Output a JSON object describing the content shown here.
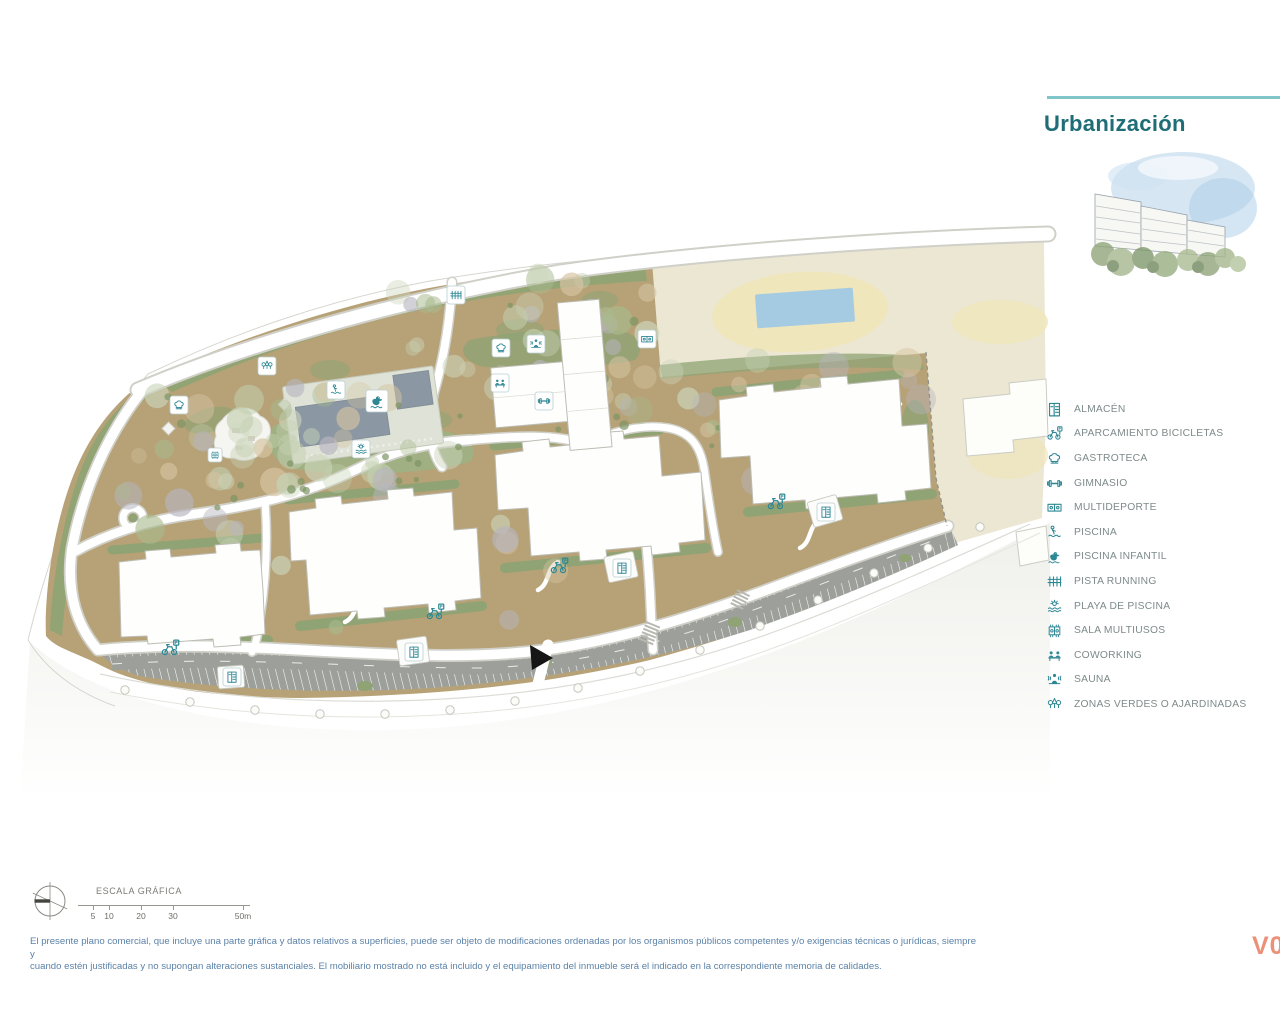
{
  "header": {
    "title": "Urbanización"
  },
  "colors": {
    "accent_line": "#7fc5c9",
    "title": "#1e6d77",
    "legend_icon": "#2e8794",
    "legend_text": "#7e8a8a",
    "disclaimer": "#5b82a8",
    "version": "#ec9077"
  },
  "legend": {
    "items": [
      {
        "icon": "almacen",
        "label": "ALMACÉN"
      },
      {
        "icon": "bicicletas",
        "label": "APARCAMIENTO BICICLETAS"
      },
      {
        "icon": "gastroteca",
        "label": "GASTROTECA"
      },
      {
        "icon": "gimnasio",
        "label": "GIMNASIO"
      },
      {
        "icon": "multideporte",
        "label": "MULTIDEPORTE"
      },
      {
        "icon": "piscina",
        "label": "PISCINA"
      },
      {
        "icon": "piscina-infantil",
        "label": "PISCINA INFANTIL"
      },
      {
        "icon": "pista-running",
        "label": "PISTA RUNNING"
      },
      {
        "icon": "playa-piscina",
        "label": "PLAYA DE PISCINA"
      },
      {
        "icon": "sala-multiusos",
        "label": "SALA MULTIUSOS"
      },
      {
        "icon": "coworking",
        "label": "COWORKING"
      },
      {
        "icon": "sauna",
        "label": "SAUNA"
      },
      {
        "icon": "zonas-verdes",
        "label": "ZONAS VERDES O AJARDINADAS"
      }
    ]
  },
  "map": {
    "badges": [
      {
        "icon": "gastroteca",
        "x": 170,
        "y": 396,
        "boxed": true
      },
      {
        "icon": "zonas-verdes",
        "x": 258,
        "y": 357,
        "boxed": true
      },
      {
        "icon": "piscina",
        "x": 327,
        "y": 381,
        "boxed": true
      },
      {
        "icon": "piscina-infantil",
        "x": 366,
        "y": 390,
        "boxed": true,
        "size": 22
      },
      {
        "icon": "playa-piscina",
        "x": 352,
        "y": 440,
        "boxed": true
      },
      {
        "icon": "sala-multiusos",
        "x": 208,
        "y": 448,
        "boxed": true,
        "size": 14
      },
      {
        "icon": "pista-running",
        "x": 447,
        "y": 286,
        "boxed": true
      },
      {
        "icon": "gastroteca",
        "x": 492,
        "y": 339,
        "boxed": true
      },
      {
        "icon": "sauna",
        "x": 527,
        "y": 335,
        "boxed": true
      },
      {
        "icon": "coworking",
        "x": 491,
        "y": 374,
        "boxed": true
      },
      {
        "icon": "gimnasio",
        "x": 535,
        "y": 392,
        "boxed": true
      },
      {
        "icon": "multideporte",
        "x": 638,
        "y": 330,
        "boxed": true
      },
      {
        "icon": "bicicletas",
        "x": 160,
        "y": 638,
        "boxed": false
      },
      {
        "icon": "almacen",
        "x": 223,
        "y": 668,
        "boxed": true
      },
      {
        "icon": "almacen",
        "x": 405,
        "y": 643,
        "boxed": true
      },
      {
        "icon": "bicicletas",
        "x": 425,
        "y": 602,
        "boxed": false
      },
      {
        "icon": "bicicletas",
        "x": 549,
        "y": 556,
        "boxed": false
      },
      {
        "icon": "almacen",
        "x": 613,
        "y": 559,
        "boxed": true
      },
      {
        "icon": "bicicletas",
        "x": 766,
        "y": 492,
        "boxed": false
      },
      {
        "icon": "almacen",
        "x": 817,
        "y": 503,
        "boxed": true
      }
    ]
  },
  "scale_bar": {
    "title": "ESCALA GRÁFICA",
    "ticks": [
      "5",
      "10",
      "20",
      "30",
      "50m"
    ]
  },
  "footer": {
    "disclaimer_line1": "El presente plano comercial, que incluye una parte gráfica y datos relativos a superficies, puede ser objeto de modificaciones ordenadas por los organismos públicos competentes y/o exigencias técnicas o jurídicas, siempre y",
    "disclaimer_line2": "cuando estén justificadas y no supongan alteraciones sustanciales. El mobiliario mostrado no está incluido y el equipamiento del inmueble será el indicado en la correspondiente memoria de calidades.",
    "version": "V0"
  }
}
